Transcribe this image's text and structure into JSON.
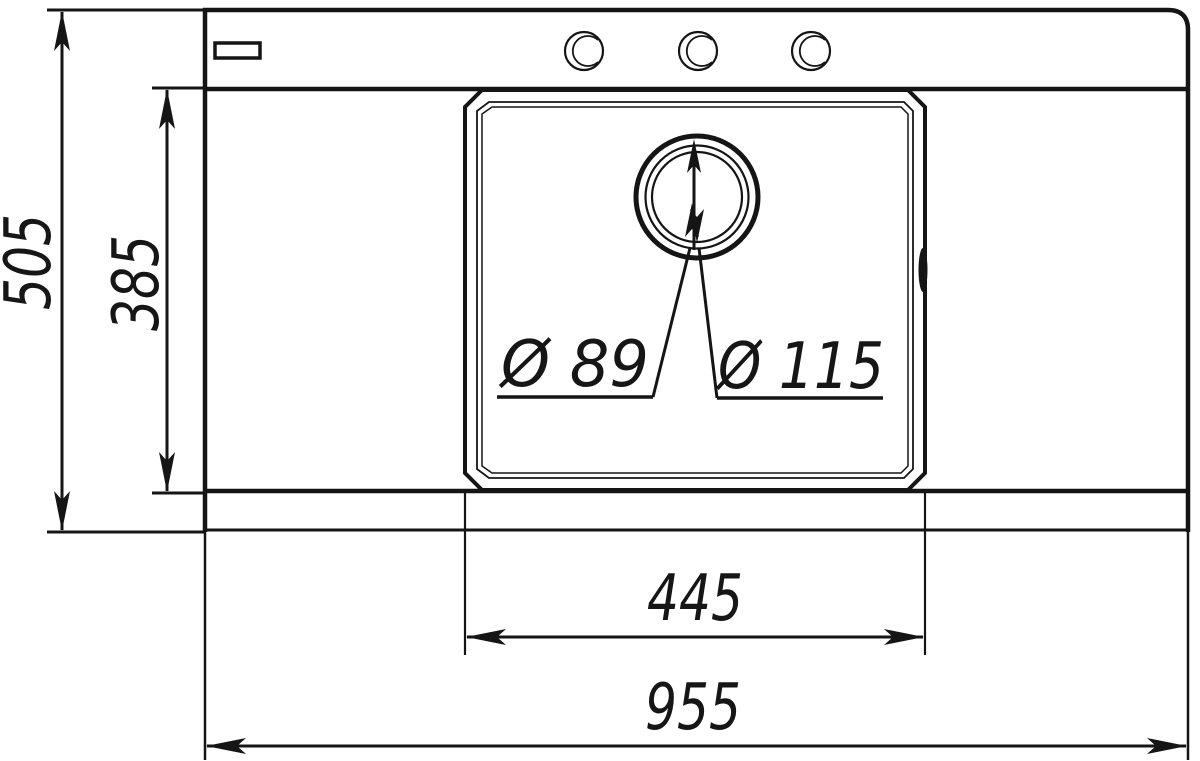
{
  "canvas": {
    "background": "#ffffff",
    "ink_color": "#151515"
  },
  "drawing": {
    "subject": "kitchen-sink-top-view-dimensional-drawing",
    "dims": {
      "overall_width": "955",
      "overall_depth": "505",
      "bowl_width": "445",
      "bowl_depth": "385",
      "drain_small_dia": "Ø 89",
      "drain_large_dia": "Ø 115"
    }
  }
}
